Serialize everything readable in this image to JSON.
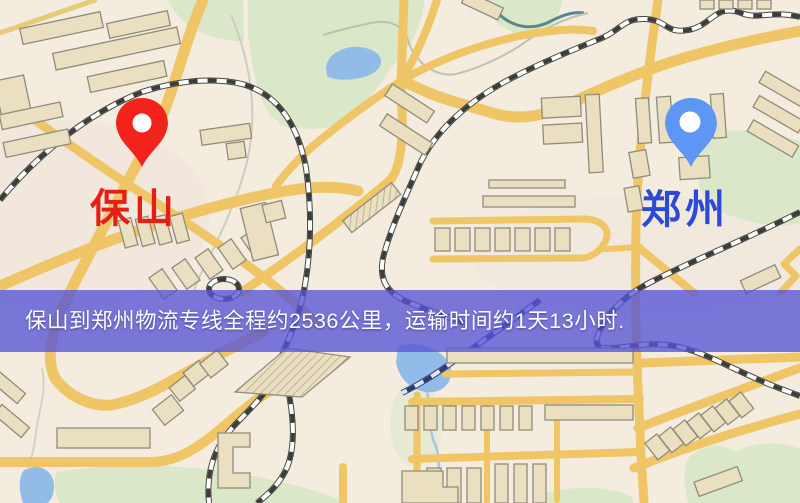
{
  "banner": {
    "text": "保山到郑州物流专线全程约2536公里，运输时间约1天13小时.",
    "background_color": "#5654d6",
    "background_opacity": "0.78",
    "text_color": "#ffffff"
  },
  "origin": {
    "label": "保山",
    "label_color": "#e71f13",
    "pin_color": "#f2231a",
    "pin_icon": "red-map-pin"
  },
  "destination": {
    "label": "郑州",
    "label_color": "#2d49d8",
    "pin_color": "#5e96f3",
    "pin_icon": "blue-map-pin"
  },
  "map_palette": {
    "background": "#f3ecdf",
    "road": "#efc566",
    "building_fill": "#ebdfc2",
    "building_outline": "#8f8c7a",
    "park_green": "#dbe7c9",
    "water_blue": "#92bbe7",
    "railway_dark": "#3c3c38"
  }
}
